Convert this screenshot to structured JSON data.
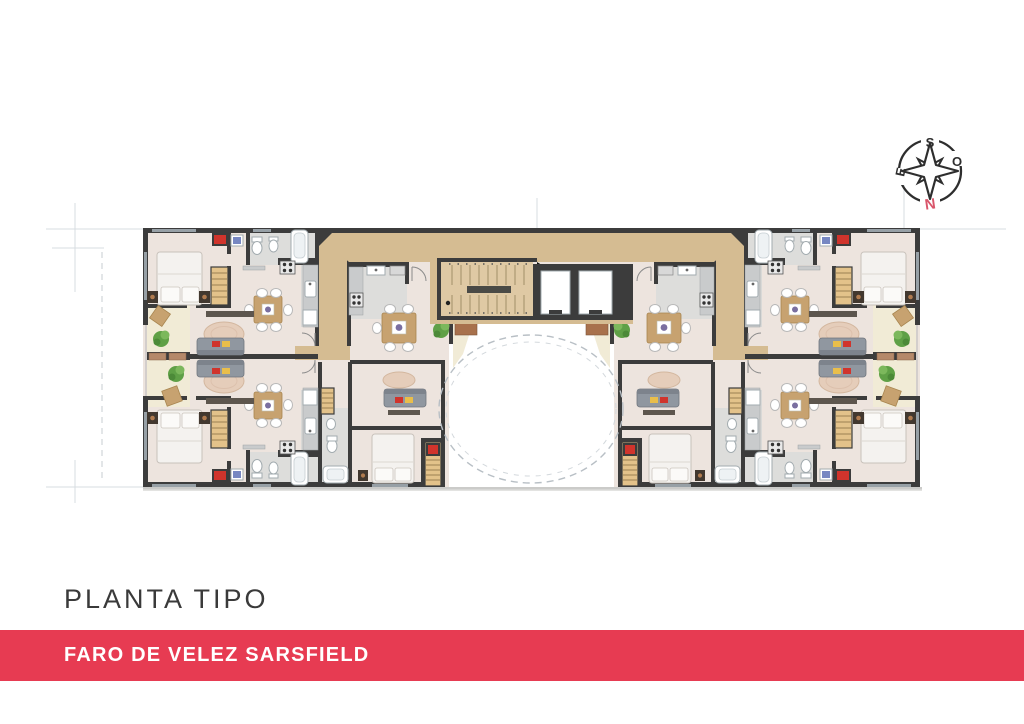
{
  "document": {
    "plan_title": "PLANTA TIPO",
    "project_banner": "FARO DE VELEZ SARSFIELD"
  },
  "compass": {
    "top": "S",
    "right": "O",
    "bottom": "N",
    "left": "E"
  },
  "colors": {
    "brand_red": "#E73B52",
    "banner_text": "#FFFFFF",
    "title_text": "#3A3A3A",
    "north_letter": "#D9566B",
    "wall_dark": "#3C3C3C",
    "corridor_tan": "#D5BC92",
    "room_floor_beige": "#EDE4DE",
    "balcony_cream": "#F1EBD6"
  }
}
